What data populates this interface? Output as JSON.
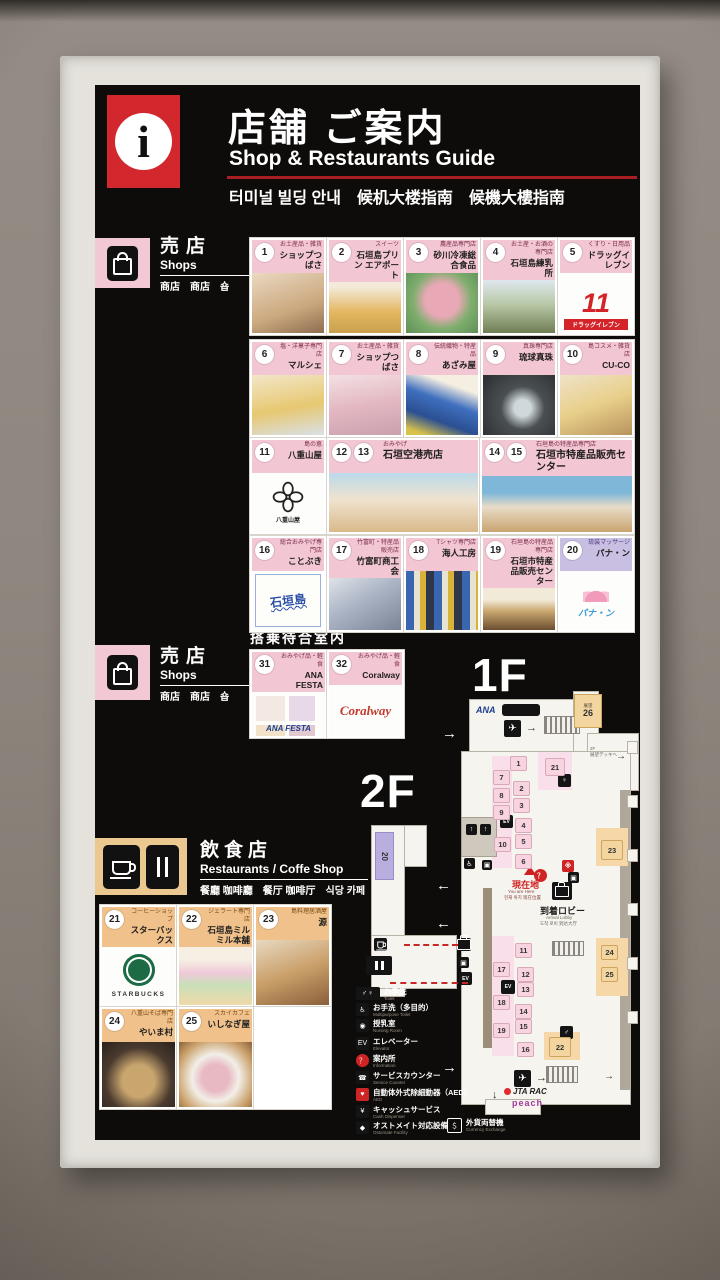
{
  "header": {
    "info_glyph": "i",
    "title_ja": "店舗 ご案内",
    "title_en": "Shop & Restaurants Guide",
    "subtitle": "터미널 빌딩 안내　候机大楼指南　候機大樓指南"
  },
  "sections": {
    "shops": {
      "ja": "売店",
      "en": "Shops",
      "multi": "商店　商店　숍"
    },
    "restaurants": {
      "ja": "飲食店",
      "en": "Restaurants / Coffe Shop",
      "multi": "餐廳 咖啡廳　餐厅 咖啡厅　식당 카페"
    },
    "lounge": "搭乗待合室内",
    "floor1": "1F",
    "floor2": "2F"
  },
  "cards": {
    "shop": [
      {
        "no": [
          "1"
        ],
        "tag": "お土産品・雑貨",
        "name": "ショップつばさ",
        "x": 250,
        "y": 238,
        "w": 72,
        "h": 93,
        "theme": "pink",
        "art": "photo-warm"
      },
      {
        "no": [
          "2"
        ],
        "tag": "スイーツ",
        "name": "石垣島プリン エアポート",
        "x": 327,
        "y": 238,
        "w": 72,
        "h": 93,
        "theme": "pink",
        "art": "photo-amber"
      },
      {
        "no": [
          "3"
        ],
        "tag": "農産品専門店",
        "name": "砂川冷凍総合食品",
        "x": 404,
        "y": 238,
        "w": 72,
        "h": 93,
        "theme": "pink",
        "art": "photo-meat"
      },
      {
        "no": [
          "4"
        ],
        "tag": "お土産・お酒の専門店",
        "name": "石垣島練乳所",
        "x": 481,
        "y": 238,
        "w": 72,
        "h": 93,
        "theme": "pink",
        "art": "photo-bottles"
      },
      {
        "no": [
          "5"
        ],
        "tag": "くすり・日用品",
        "name": "ドラッグイレブン",
        "x": 558,
        "y": 238,
        "w": 72,
        "h": 93,
        "theme": "pink",
        "art": "logo-drug11",
        "logo": "11",
        "band": "ドラッグイレブン"
      },
      {
        "no": [
          "6"
        ],
        "tag": "塩・洋菓子専門店",
        "name": "マルシェ",
        "x": 250,
        "y": 340,
        "w": 72,
        "h": 93,
        "theme": "pink",
        "art": "photo-sweets"
      },
      {
        "no": [
          "7"
        ],
        "tag": "お土産品・雑貨",
        "name": "ショップつばさ",
        "x": 327,
        "y": 340,
        "w": 72,
        "h": 93,
        "theme": "pink",
        "art": "photo-goods"
      },
      {
        "no": [
          "8"
        ],
        "tag": "伝統織物・特産品",
        "name": "あざみ屋",
        "x": 404,
        "y": 340,
        "w": 72,
        "h": 93,
        "theme": "pink",
        "art": "photo-textile"
      },
      {
        "no": [
          "9"
        ],
        "tag": "真珠専門店",
        "name": "琉球真珠",
        "x": 481,
        "y": 340,
        "w": 72,
        "h": 93,
        "theme": "pink",
        "art": "photo-pearls"
      },
      {
        "no": [
          "10"
        ],
        "tag": "島コスメ・雑貨店",
        "name": "CU-CO",
        "x": 558,
        "y": 340,
        "w": 72,
        "h": 93,
        "theme": "pink",
        "art": "photo-cosme"
      },
      {
        "no": [
          "11"
        ],
        "tag": "島の恵",
        "name": "八重山屋",
        "x": 250,
        "y": 438,
        "w": 72,
        "h": 92,
        "theme": "pink",
        "art": "logo-yaeyama",
        "logo": "八重山屋"
      },
      {
        "no": [
          "12",
          "13"
        ],
        "tag": "おみやげ",
        "name": "石垣空港売店",
        "x": 327,
        "y": 438,
        "w": 149,
        "h": 92,
        "theme": "pink",
        "art": "photo-shop",
        "wide": true
      },
      {
        "no": [
          "14",
          "15"
        ],
        "tag": "石垣島の特産品専門店",
        "name": "石垣市特産品販売センター",
        "x": 480,
        "y": 438,
        "w": 150,
        "h": 92,
        "theme": "pink",
        "art": "photo-center",
        "wide": true
      },
      {
        "no": [
          "16"
        ],
        "tag": "総合おみやげ専門店",
        "name": "ことぶき",
        "x": 250,
        "y": 536,
        "w": 72,
        "h": 92,
        "theme": "pink",
        "art": "sketch-blue",
        "logo": "石垣島"
      },
      {
        "no": [
          "17"
        ],
        "tag": "竹富町・特産品販売店",
        "name": "竹富町商工会",
        "x": 327,
        "y": 536,
        "w": 72,
        "h": 92,
        "theme": "pink",
        "art": "photo-crafts"
      },
      {
        "no": [
          "18"
        ],
        "tag": "Tシャツ専門店",
        "name": "海人工房",
        "x": 404,
        "y": 536,
        "w": 72,
        "h": 92,
        "theme": "pink",
        "art": "photo-tshirts"
      },
      {
        "no": [
          "19"
        ],
        "tag": "石垣島の特産品専門店",
        "name": "石垣市特産品販売センター",
        "x": 481,
        "y": 536,
        "w": 72,
        "h": 92,
        "theme": "pink",
        "art": "photo-bottles2"
      },
      {
        "no": [
          "20"
        ],
        "tag": "琉装マッサージ",
        "name": "パナ・ン",
        "x": 558,
        "y": 536,
        "w": 72,
        "h": 92,
        "theme": "lavender",
        "art": "logo-panan",
        "logo": "パナ・ン"
      }
    ],
    "lounge": [
      {
        "no": [
          "31"
        ],
        "tag": "おみやげ品・軽食",
        "name": "ANA FESTA",
        "x": 250,
        "y": 650,
        "w": 73,
        "h": 84,
        "theme": "pink",
        "art": "logo-anafesta",
        "logo": "ANA FESTA"
      },
      {
        "no": [
          "32"
        ],
        "tag": "おみやげ品・軽食",
        "name": "Coralway",
        "x": 327,
        "y": 650,
        "w": 73,
        "h": 84,
        "theme": "pink",
        "art": "logo-coralway",
        "logo": "Coralway"
      }
    ],
    "restaurant": [
      {
        "no": [
          "21"
        ],
        "tag": "コーヒーショップ",
        "name": "スターバックス",
        "x": 100,
        "y": 905,
        "w": 73,
        "h": 98,
        "theme": "orange",
        "art": "logo-starbucks",
        "logo": "STARBUCKS"
      },
      {
        "no": [
          "22"
        ],
        "tag": "ジェラート専門店",
        "name": "石垣島ミルミル本舗",
        "x": 177,
        "y": 905,
        "w": 73,
        "h": 98,
        "theme": "orange",
        "art": "photo-gelato"
      },
      {
        "no": [
          "23"
        ],
        "tag": "島料理居酒屋",
        "name": "源",
        "x": 254,
        "y": 905,
        "w": 73,
        "h": 98,
        "theme": "orange",
        "art": "photo-dishes"
      },
      {
        "no": [
          "24"
        ],
        "tag": "八重山そば専門店",
        "name": "やいま村",
        "x": 100,
        "y": 1007,
        "w": 73,
        "h": 98,
        "theme": "orange",
        "art": "photo-soba"
      },
      {
        "no": [
          "25"
        ],
        "tag": "スカイカフェ",
        "name": "いしなぎ屋",
        "x": 177,
        "y": 1007,
        "w": 73,
        "h": 98,
        "theme": "orange",
        "art": "photo-beef"
      },
      {
        "no": [],
        "tag": "",
        "name": "",
        "x": 254,
        "y": 1007,
        "w": 73,
        "h": 98,
        "theme": "blank",
        "art": ""
      }
    ]
  },
  "map": {
    "obs": {
      "label": "展望",
      "no": "26"
    },
    "chip20": "20",
    "you_are_here": {
      "ja": "現在地",
      "en": "You are Here",
      "multi": "현재 위치  现在位置"
    },
    "arrival_lobby": {
      "ja": "到着ロビー",
      "en": "Arrival Lobby",
      "multi": "도착 로비  到达大厅"
    },
    "deck_note_1": "2F",
    "deck_note_2": "展望デッキへ",
    "airlines": {
      "ana": "ANA",
      "jta": "JTA RAC",
      "peach": "peach"
    },
    "chips": [
      {
        "n": "1",
        "x": 510,
        "y": 756,
        "c": "p"
      },
      {
        "n": "7",
        "x": 493,
        "y": 770,
        "c": "p"
      },
      {
        "n": "2",
        "x": 513,
        "y": 781,
        "c": "p"
      },
      {
        "n": "8",
        "x": 493,
        "y": 788,
        "c": "p"
      },
      {
        "n": "3",
        "x": 513,
        "y": 798,
        "c": "p"
      },
      {
        "n": "9",
        "x": 493,
        "y": 805,
        "c": "p"
      },
      {
        "n": "4",
        "x": 515,
        "y": 818,
        "c": "p"
      },
      {
        "n": "5",
        "x": 515,
        "y": 834,
        "c": "p"
      },
      {
        "n": "10",
        "x": 494,
        "y": 837,
        "c": "p"
      },
      {
        "n": "6",
        "x": 515,
        "y": 854,
        "c": "p"
      },
      {
        "n": "21",
        "x": 545,
        "y": 758,
        "c": "p",
        "w": 18,
        "h": 16
      },
      {
        "n": "11",
        "x": 515,
        "y": 943,
        "c": "p"
      },
      {
        "n": "17",
        "x": 493,
        "y": 962,
        "c": "p"
      },
      {
        "n": "12",
        "x": 517,
        "y": 967,
        "c": "p"
      },
      {
        "n": "13",
        "x": 517,
        "y": 982,
        "c": "p"
      },
      {
        "n": "18",
        "x": 493,
        "y": 995,
        "c": "p"
      },
      {
        "n": "14",
        "x": 515,
        "y": 1004,
        "c": "p"
      },
      {
        "n": "15",
        "x": 515,
        "y": 1019,
        "c": "p"
      },
      {
        "n": "19",
        "x": 493,
        "y": 1023,
        "c": "p"
      },
      {
        "n": "16",
        "x": 517,
        "y": 1042,
        "c": "p"
      },
      {
        "n": "23",
        "x": 601,
        "y": 840,
        "c": "o",
        "w": 20,
        "h": 18
      },
      {
        "n": "24",
        "x": 601,
        "y": 945,
        "c": "o"
      },
      {
        "n": "25",
        "x": 601,
        "y": 967,
        "c": "o"
      },
      {
        "n": "22",
        "x": 549,
        "y": 1037,
        "c": "o",
        "w": 20,
        "h": 18
      }
    ]
  },
  "legend": [
    {
      "icon": "toilet-icon",
      "glyph": "♂♀",
      "label": "お手洗",
      "sub": "Toilet",
      "wide": true
    },
    {
      "icon": "accessible-toilet-icon",
      "glyph": "♿",
      "label": "お手洗（多目的）",
      "sub": "Multipurpose Toilet"
    },
    {
      "icon": "nursing-room-icon",
      "glyph": "◉",
      "label": "授乳室",
      "sub": "Nursing Room"
    },
    {
      "icon": "elevator-icon",
      "glyph": "EV",
      "label": "エレベーター",
      "sub": "Elevator"
    },
    {
      "icon": "information-icon",
      "glyph": "？",
      "label": "案内所",
      "sub": "Information",
      "circle": true
    },
    {
      "icon": "service-counter-icon",
      "glyph": "☎",
      "label": "サービスカウンター",
      "sub": "Service Counter"
    },
    {
      "icon": "aed-icon",
      "glyph": "♥",
      "label": "自動体外式除細動器（AED）",
      "sub": "AED",
      "red": true
    },
    {
      "icon": "cash-service-icon",
      "glyph": "¥",
      "label": "キャッシュサービス",
      "sub": "Cash Dispenser"
    },
    {
      "icon": "ostomate-icon",
      "glyph": "◆",
      "label": "オストメイト対応設備",
      "sub": "Ostomate Facility"
    },
    {
      "icon": "currency-exchange-icon",
      "glyph": "＄",
      "label": "外貨両替機",
      "sub": "Currency Exchange",
      "outline": true,
      "right": true
    }
  ]
}
